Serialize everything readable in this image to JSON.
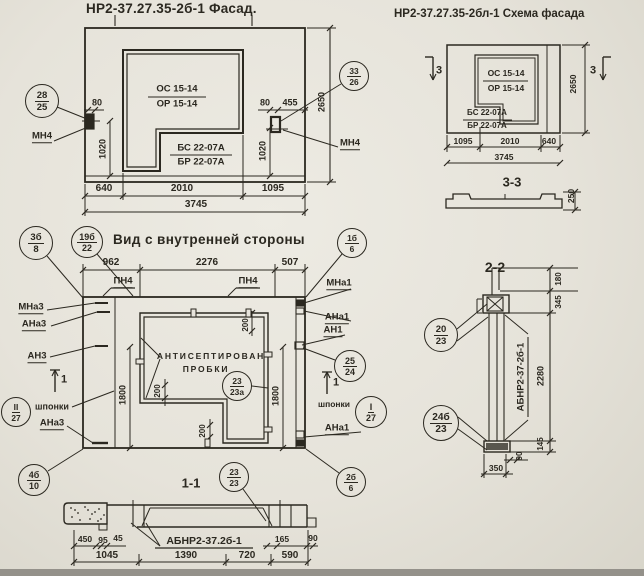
{
  "meta": {
    "ink": "#2b2820",
    "paper": "#e7e4dc",
    "strip": "#94918a"
  },
  "titles": {
    "facade": "НР2-37.27.35-2б-1 Фасад.",
    "scheme": "НР2-37.27.35-2бл-1 Схема фасада",
    "inner_view": "Вид с внутренней стороны"
  },
  "labels": [
    {
      "t": "80",
      "x": 97,
      "y": 103,
      "s": 9,
      "n": "dim-80-left"
    },
    {
      "t": "1020",
      "x": 103,
      "y": 149,
      "s": 9,
      "r": -90,
      "n": "dim-1020-left"
    },
    {
      "t": "ОС 15-14",
      "x": 177,
      "y": 89,
      "s": 9.5,
      "n": "mark-os-15-14"
    },
    {
      "t": "ОР 15-14",
      "x": 177,
      "y": 104,
      "s": 9.5,
      "n": "mark-or-15-14"
    },
    {
      "t": "БС 22-07А",
      "x": 201,
      "y": 148,
      "s": 9.5,
      "n": "mark-bs-22-07a"
    },
    {
      "t": "БР 22-07А",
      "x": 201,
      "y": 162,
      "s": 9.5,
      "n": "mark-br-22-07a"
    },
    {
      "t": "80",
      "x": 265,
      "y": 103,
      "s": 9,
      "n": "dim-80-right"
    },
    {
      "t": "455",
      "x": 290,
      "y": 103,
      "s": 9,
      "n": "dim-455"
    },
    {
      "t": "1020",
      "x": 263,
      "y": 151,
      "s": 9,
      "r": -90,
      "n": "dim-1020-right"
    },
    {
      "t": "2650",
      "x": 322,
      "y": 102,
      "s": 9,
      "r": -90,
      "n": "dim-2650-facade"
    },
    {
      "t": "МН4",
      "x": 42,
      "y": 137,
      "s": 9.5,
      "u": 1,
      "n": "anchor-mn4-left"
    },
    {
      "t": "МН4",
      "x": 350,
      "y": 144,
      "s": 9.5,
      "u": 1,
      "n": "anchor-mn4-right"
    },
    {
      "t": "640",
      "x": 104,
      "y": 189,
      "s": 10,
      "n": "dim-640"
    },
    {
      "t": "2010",
      "x": 182,
      "y": 189,
      "s": 10,
      "n": "dim-2010"
    },
    {
      "t": "1095",
      "x": 273,
      "y": 189,
      "s": 10,
      "n": "dim-1095"
    },
    {
      "t": "3745",
      "x": 196,
      "y": 205,
      "s": 10,
      "n": "dim-3745-facade"
    },
    {
      "t": "3",
      "x": 439,
      "y": 71,
      "s": 11,
      "n": "section-mark-3-left"
    },
    {
      "t": "3",
      "x": 593,
      "y": 71,
      "s": 11,
      "n": "section-mark-3-right"
    },
    {
      "t": "ОС 15-14",
      "x": 506,
      "y": 73,
      "s": 8.5,
      "n": "mark-os-15-14-scheme"
    },
    {
      "t": "ОР 15-14",
      "x": 506,
      "y": 88,
      "s": 8.5,
      "n": "mark-or-15-14-scheme"
    },
    {
      "t": "БС 22-07А",
      "x": 487,
      "y": 113,
      "s": 8,
      "n": "mark-bs-scheme"
    },
    {
      "t": "БР 22-07А",
      "x": 487,
      "y": 126,
      "s": 8,
      "n": "mark-br-scheme"
    },
    {
      "t": "2650",
      "x": 573,
      "y": 84,
      "s": 8.5,
      "r": -90,
      "n": "dim-2650-scheme"
    },
    {
      "t": "1095",
      "x": 463,
      "y": 141,
      "s": 8.5,
      "n": "dim-1095-scheme"
    },
    {
      "t": "2010",
      "x": 510,
      "y": 141,
      "s": 8.5,
      "n": "dim-2010-scheme"
    },
    {
      "t": "640",
      "x": 549,
      "y": 141,
      "s": 8.5,
      "n": "dim-640-scheme"
    },
    {
      "t": "3745",
      "x": 504,
      "y": 157,
      "s": 8.5,
      "n": "dim-3745-scheme"
    },
    {
      "t": "3-3",
      "x": 512,
      "y": 182,
      "s": 13,
      "n": "section-3-3-label"
    },
    {
      "t": "250",
      "x": 571,
      "y": 196,
      "s": 8.5,
      "r": -90,
      "n": "dim-250"
    },
    {
      "t": "962",
      "x": 111,
      "y": 263,
      "s": 10,
      "n": "dim-962"
    },
    {
      "t": "2276",
      "x": 207,
      "y": 263,
      "s": 10,
      "n": "dim-2276"
    },
    {
      "t": "507",
      "x": 290,
      "y": 263,
      "s": 10,
      "n": "dim-507"
    },
    {
      "t": "ПН4",
      "x": 123,
      "y": 282,
      "s": 9.5,
      "u": 1,
      "n": "anchor-pn4-left"
    },
    {
      "t": "ПН4",
      "x": 248,
      "y": 282,
      "s": 9.5,
      "u": 1,
      "n": "anchor-pn4-right"
    },
    {
      "t": "МНа3",
      "x": 31,
      "y": 308,
      "s": 9.5,
      "u": 1,
      "n": "anchor-mna3"
    },
    {
      "t": "АНа3",
      "x": 34,
      "y": 325,
      "s": 9.5,
      "u": 1,
      "n": "anchor-ana3"
    },
    {
      "t": "АН3",
      "x": 37,
      "y": 357,
      "s": 9.5,
      "u": 1,
      "n": "anchor-an3"
    },
    {
      "t": "МНа1",
      "x": 339,
      "y": 284,
      "s": 9.5,
      "u": 1,
      "n": "anchor-mna1"
    },
    {
      "t": "АНа1",
      "x": 337,
      "y": 318,
      "s": 9.5,
      "u": 1,
      "n": "anchor-ana1"
    },
    {
      "t": "АН1",
      "x": 333,
      "y": 331,
      "s": 9.5,
      "u": 1,
      "n": "anchor-an1"
    },
    {
      "t": "200",
      "x": 246,
      "y": 325,
      "s": 8,
      "r": -90,
      "n": "dim-200-top"
    },
    {
      "t": "200",
      "x": 158,
      "y": 391,
      "s": 8,
      "r": -90,
      "n": "dim-200-left"
    },
    {
      "t": "200",
      "x": 203,
      "y": 431,
      "s": 8,
      "r": -90,
      "n": "dim-200-bottom"
    },
    {
      "t": "1800",
      "x": 123,
      "y": 395,
      "s": 9,
      "r": -90,
      "n": "dim-1800-left"
    },
    {
      "t": "1800",
      "x": 276,
      "y": 396,
      "s": 9,
      "r": -90,
      "n": "dim-1800-right"
    },
    {
      "t": "АНТИСЕПТИРОВАН",
      "x": 211,
      "y": 356,
      "s": 8.5,
      "sp": 1,
      "n": "note-antiseptic"
    },
    {
      "t": "ПРОБКИ",
      "x": 206,
      "y": 369,
      "s": 8.5,
      "sp": 1,
      "n": "note-plugs"
    },
    {
      "t": "шпонки",
      "x": 52,
      "y": 407,
      "s": 9,
      "n": "note-shponki-left"
    },
    {
      "t": "АНа3",
      "x": 52,
      "y": 424,
      "s": 9.5,
      "u": 1,
      "n": "anchor-ana3-bottom"
    },
    {
      "t": "шпонки",
      "x": 334,
      "y": 404,
      "s": 8.5,
      "n": "note-shponki-right"
    },
    {
      "t": "АНа1",
      "x": 337,
      "y": 429,
      "s": 9.5,
      "u": 1,
      "n": "anchor-ana1-bottom"
    },
    {
      "t": "1",
      "x": 64,
      "y": 380,
      "s": 11,
      "n": "section-mark-1-left"
    },
    {
      "t": "1",
      "x": 336,
      "y": 383,
      "s": 11,
      "n": "section-mark-1-right"
    },
    {
      "t": "1-1",
      "x": 191,
      "y": 483,
      "s": 13,
      "n": "section-1-1-label"
    },
    {
      "t": "450",
      "x": 85,
      "y": 539,
      "s": 8.5,
      "n": "dim-450"
    },
    {
      "t": "95",
      "x": 103,
      "y": 540,
      "s": 8.5,
      "n": "dim-95"
    },
    {
      "t": "45",
      "x": 118,
      "y": 538,
      "s": 8.5,
      "n": "dim-45"
    },
    {
      "t": "АБНР2-37.2б-1",
      "x": 204,
      "y": 541,
      "s": 10.5,
      "n": "part-abnr2-37-2b-1"
    },
    {
      "t": "165",
      "x": 282,
      "y": 539,
      "s": 8.5,
      "n": "dim-165"
    },
    {
      "t": "90",
      "x": 313,
      "y": 538,
      "s": 8.5,
      "n": "dim-90-s11"
    },
    {
      "t": "1045",
      "x": 107,
      "y": 556,
      "s": 10,
      "n": "dim-1045"
    },
    {
      "t": "1390",
      "x": 186,
      "y": 556,
      "s": 10,
      "n": "dim-1390"
    },
    {
      "t": "720",
      "x": 247,
      "y": 556,
      "s": 10,
      "n": "dim-720"
    },
    {
      "t": "590",
      "x": 290,
      "y": 556,
      "s": 10,
      "n": "dim-590"
    },
    {
      "t": "2-2",
      "x": 495,
      "y": 267,
      "s": 14,
      "n": "section-2-2-label"
    },
    {
      "t": "АБНР2-37-2б-1",
      "x": 521,
      "y": 377,
      "s": 9.5,
      "r": -90,
      "n": "part-abnr2-37-2b-1-s22"
    },
    {
      "t": "180",
      "x": 559,
      "y": 279,
      "s": 8,
      "r": -90,
      "n": "dim-180"
    },
    {
      "t": "345",
      "x": 559,
      "y": 302,
      "s": 8,
      "r": -90,
      "n": "dim-345"
    },
    {
      "t": "2280",
      "x": 541,
      "y": 376,
      "s": 9,
      "r": -90,
      "n": "dim-2280"
    },
    {
      "t": "145",
      "x": 541,
      "y": 444,
      "s": 8,
      "r": -90,
      "n": "dim-145"
    },
    {
      "t": "90",
      "x": 520,
      "y": 456,
      "s": 8,
      "r": -90,
      "n": "dim-90-s22"
    },
    {
      "t": "350",
      "x": 496,
      "y": 468,
      "s": 8.5,
      "n": "dim-350"
    }
  ],
  "markers": [
    {
      "a": "28",
      "b": "25",
      "x": 42,
      "y": 101,
      "r": 17
    },
    {
      "a": "33",
      "b": "26",
      "x": 354,
      "y": 76,
      "r": 15
    },
    {
      "a": "3б",
      "b": "8",
      "x": 36,
      "y": 243,
      "r": 17
    },
    {
      "a": "19б",
      "b": "22",
      "x": 87,
      "y": 242,
      "r": 16
    },
    {
      "a": "1б",
      "b": "6",
      "x": 352,
      "y": 243,
      "r": 15
    },
    {
      "a": "II",
      "b": "27",
      "x": 16,
      "y": 412,
      "r": 15
    },
    {
      "a": "4б",
      "b": "10",
      "x": 34,
      "y": 480,
      "r": 16
    },
    {
      "a": "25",
      "b": "24",
      "x": 350,
      "y": 366,
      "r": 16
    },
    {
      "a": "I",
      "b": "27",
      "x": 371,
      "y": 412,
      "r": 16
    },
    {
      "a": "23",
      "b": "23а",
      "x": 237,
      "y": 386,
      "r": 15
    },
    {
      "a": "2б",
      "b": "6",
      "x": 351,
      "y": 482,
      "r": 15
    },
    {
      "a": "23",
      "b": "23",
      "x": 234,
      "y": 477,
      "r": 15
    },
    {
      "a": "20",
      "b": "23",
      "x": 441,
      "y": 335,
      "r": 17
    },
    {
      "a": "24б",
      "b": "23",
      "x": 441,
      "y": 423,
      "r": 18
    }
  ]
}
